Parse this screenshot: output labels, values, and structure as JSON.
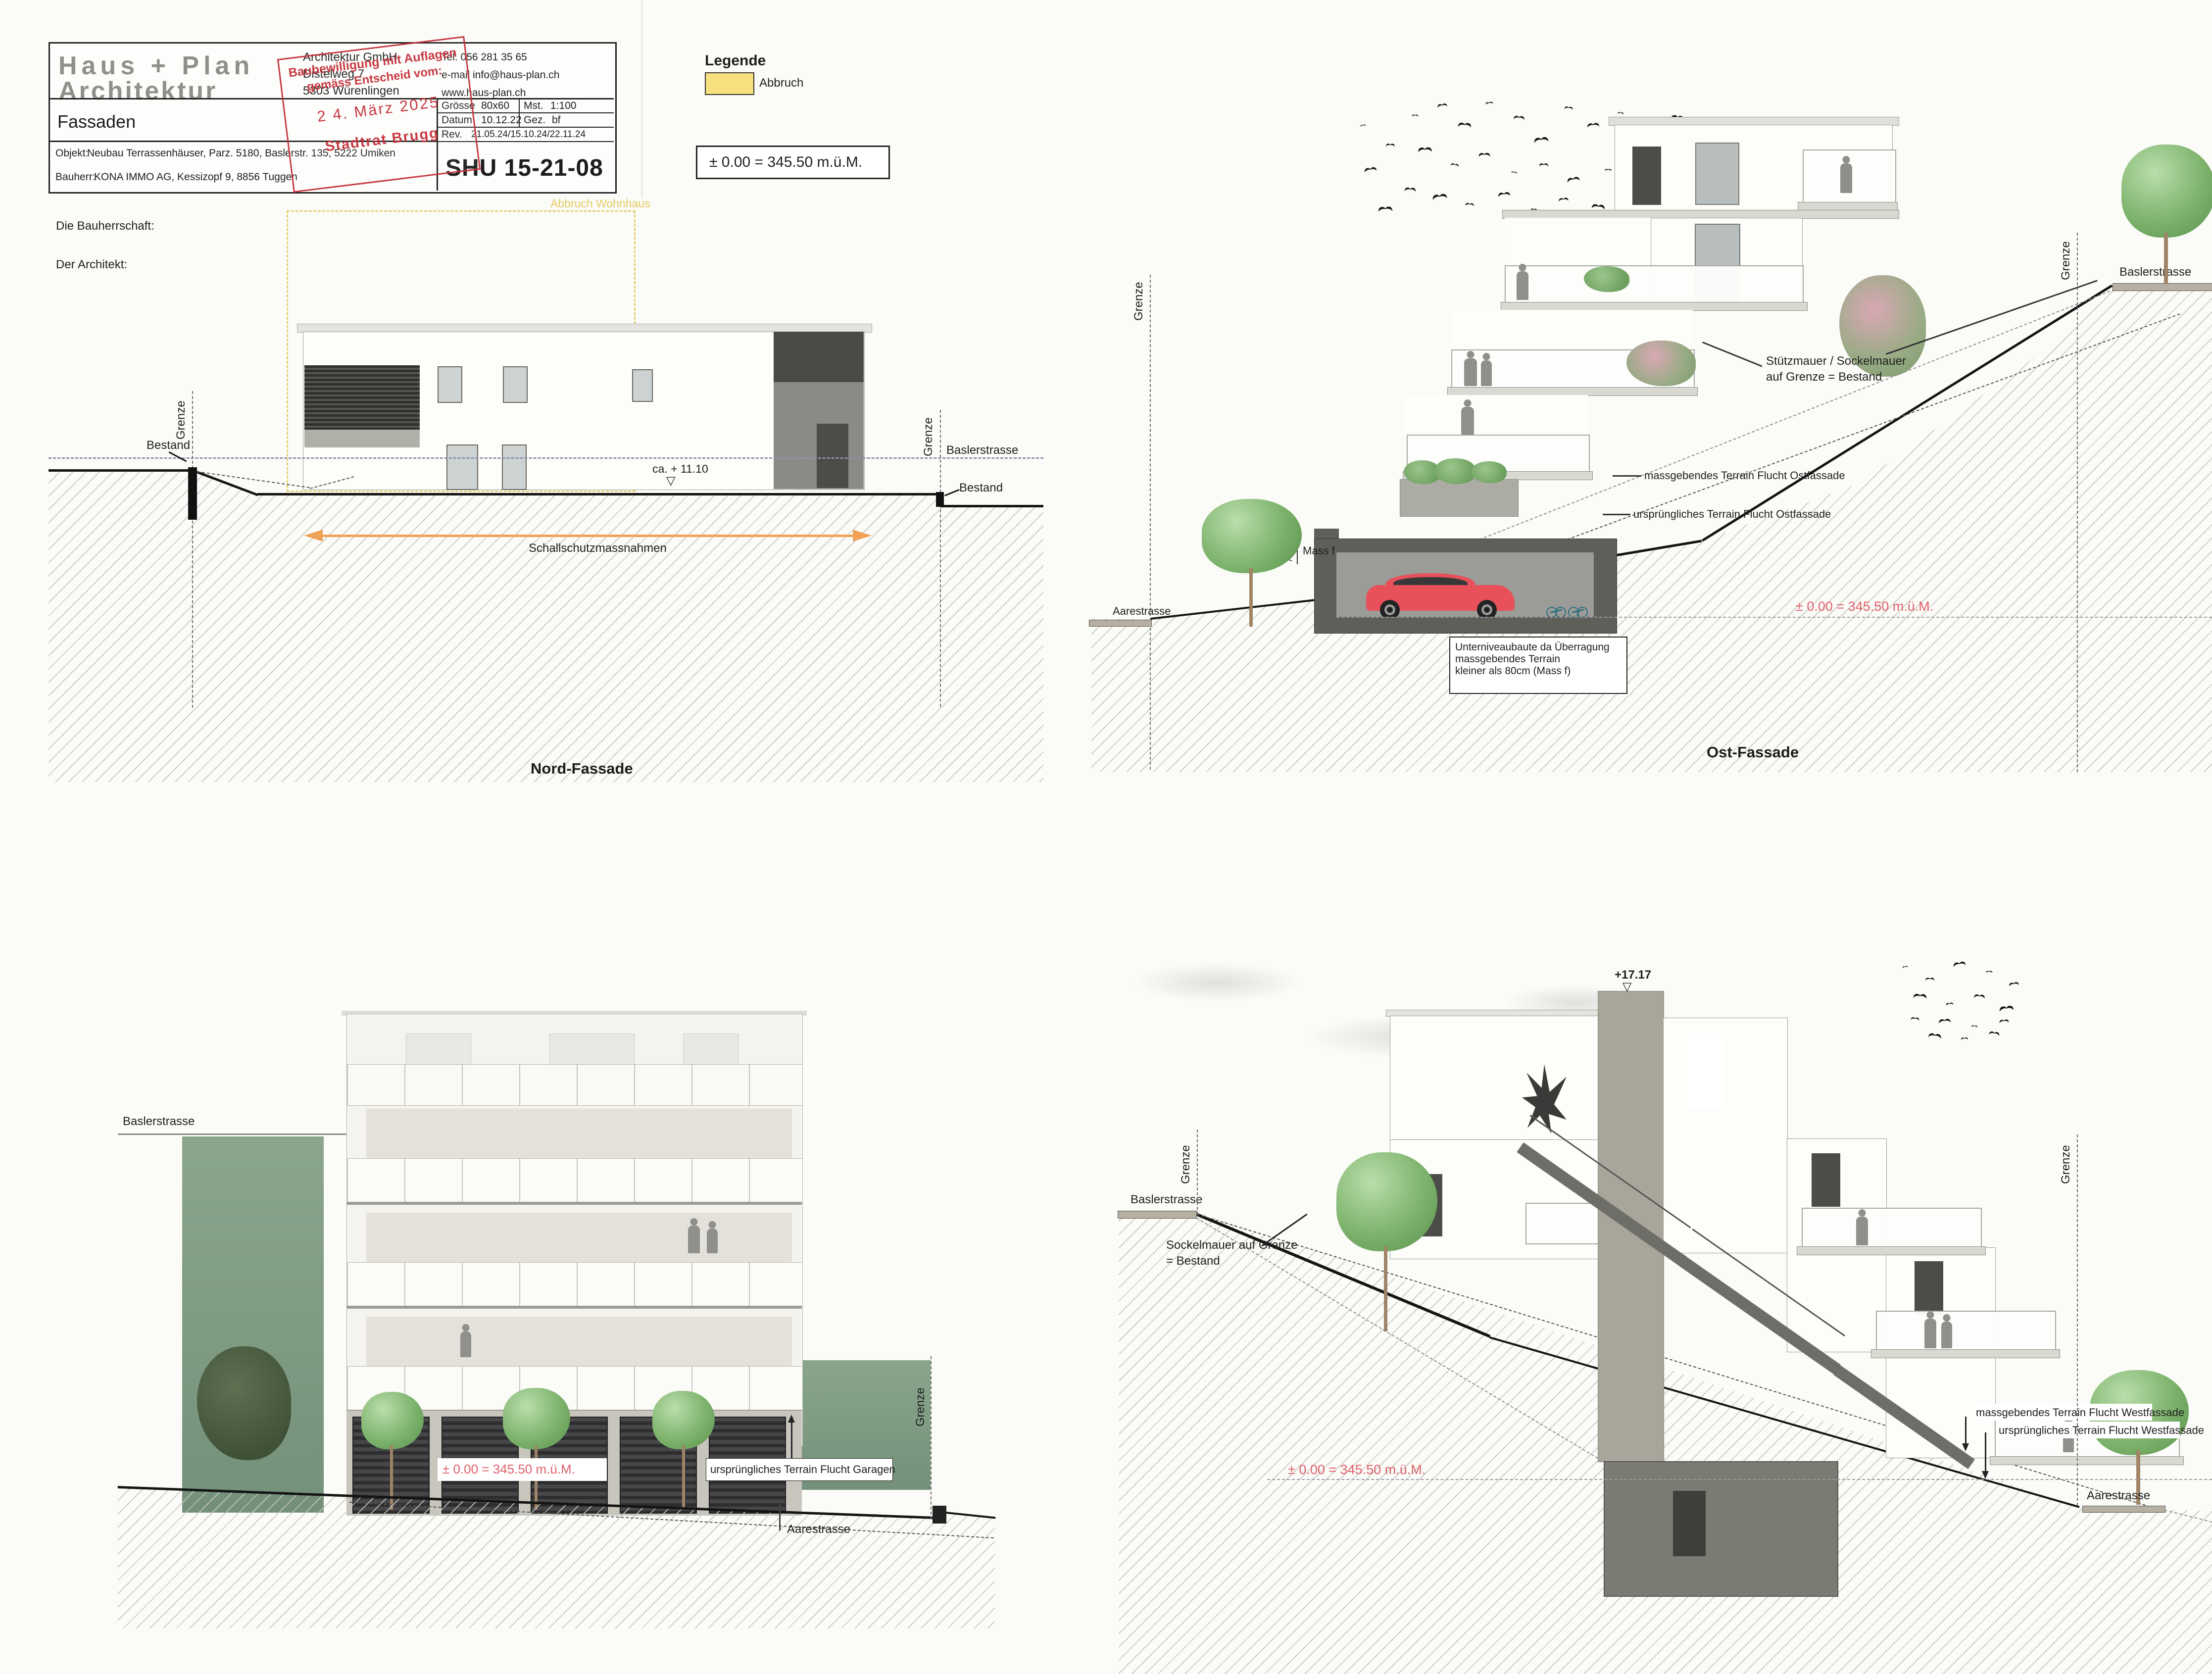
{
  "title_block": {
    "logo_line1": "Haus + Plan",
    "logo_line2": "Architektur",
    "company": "Architektur GmbH",
    "address_line1": "Distelweg 7",
    "address_line2": "5303 Würenlingen",
    "tel": "Tel. 056 281 35 65",
    "email": "e-mail   info@haus-plan.ch",
    "web": "www.haus-plan.ch",
    "doc_title": "Fassaden",
    "groesse_label": "Grösse",
    "groesse_value": "80x60",
    "mst_label": "Mst.",
    "mst_value": "1:100",
    "datum_label": "Datum",
    "datum_value": "10.12.22",
    "gez_label": "Gez.",
    "gez_value": "bf",
    "rev_label": "Rev.",
    "rev_value": "21.05.24/15.10.24/22.11.24",
    "objekt_label": "Objekt:",
    "objekt_value": "Neubau Terrassenhäuser, Parz. 5180, Baslerstr. 135, 5222 Umiken",
    "bauherr_label": "Bauherr:",
    "bauherr_value": "KONA IMMO AG, Kessizopf 9, 8856 Tuggen",
    "plan_number": "SHU 15-21-08",
    "stamp": {
      "line1": "Baubewilligung mit Auflagen",
      "line2": "gemäss Entscheid vom:",
      "date": "2 4. März  2025",
      "authority": "Stadtrat Brugg"
    }
  },
  "legend": {
    "heading": "Legende",
    "abbruch_label": "Abbruch",
    "level_note": "± 0.00 = 345.50 m.ü.M."
  },
  "signatures": {
    "bauherrschaft_label": "Die Bauherrschaft:",
    "architekt_label": "Der Architekt:"
  },
  "nord": {
    "title": "Nord-Fassade",
    "abbruch_note": "Abbruch Wohnhaus",
    "bestand_left": "Bestand",
    "bestand_right": "Bestand",
    "grenze_left": "Grenze",
    "grenze_right": "Grenze",
    "baslerstrasse_label": "Baslerstrasse",
    "height_note": "ca. + 11.10",
    "level_marker": "▽",
    "schallschutz_label": "Schallschutzmassnahmen"
  },
  "ost": {
    "title": "Ost-Fassade",
    "grenze_left": "Grenze",
    "grenze_right": "Grenze",
    "baslerstrasse_label": "Baslerstrasse",
    "aarestrasse_label": "Aarestrasse",
    "stuetzmauer_line1": "Stützmauer / Sockelmauer",
    "stuetzmauer_line2": "auf Grenze = Bestand",
    "massgebend_label": "massgebendes Terrain Flucht Ostfassade",
    "urspruenglich_label": "ursprüngliches Terrain Flucht Ostfassade",
    "mass_f_label": "Mass f",
    "mass_f_value": "74",
    "level_note": "± 0.00 = 345.50 m.ü.M.",
    "unterniveau_line1": "Unterniveaubaute da Überragung",
    "unterniveau_line2": "massgebendes Terrain",
    "unterniveau_line3": "kleiner als 80cm (Mass f)"
  },
  "west_elevation": {
    "baslerstrasse_label": "Baslerstrasse",
    "grenze_label": "Grenze",
    "level_note": "± 0.00 = 345.50 m.ü.M.",
    "terrain_note": "ursprüngliches Terrain Flucht Garagen",
    "aarestrasse_label": "Aarestrasse"
  },
  "west_section": {
    "peak_level": "+17.17",
    "level_marker": "▽",
    "baslerstrasse_label": "Baslerstrasse",
    "grenze_left": "Grenze",
    "grenze_right": "Grenze",
    "sockelmauer_line1": "Sockelmauer auf Grenze",
    "sockelmauer_line2": "= Bestand",
    "massgebend_label": "massgebendes Terrain Flucht Westfassade",
    "urspruenglich_label": "ursprüngliches Terrain Flucht Westfassade",
    "level_note": "± 0.00 = 345.50 m.ü.M.",
    "aarestrasse_label": "Aarestrasse"
  },
  "colors": {
    "stamp_red": "#c5303a",
    "abbruch_yellow": "#f6df7d",
    "level_red": "#e0606a",
    "arrow_orange": "#f0a258",
    "tree_green": "#7db36c",
    "wall_green": "#86a188",
    "car_red": "#e8505a"
  }
}
